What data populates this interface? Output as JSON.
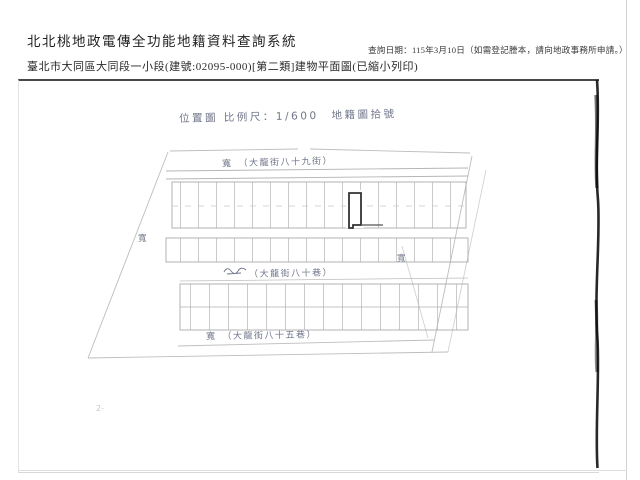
{
  "header": {
    "system_title": "北北桃地政電傳全功能地籍資料查詢系統",
    "document_title": "臺北市大同區大同段一小段(建號:02095-000)[第二類]建物平面圖(已縮小列印)",
    "query_date": "查詢日期：115年3月10日（如需登記謄本，請向地政事務所申請。）"
  },
  "plan": {
    "caption": "位置圖 比例尺：1/600　地籍圖拾號",
    "street_top": "寬　（大龍街八十九街）",
    "street_middle": "（大龍街八十巷）",
    "street_bottom": "寬　（大龍街八十五巷）",
    "width_mark_left": "寬",
    "width_mark_right": "寬",
    "corner_note": "2-"
  },
  "colors": {
    "ink": "#70768a",
    "scan_line": "#b3b3b3",
    "subject_outline": "#333333"
  }
}
